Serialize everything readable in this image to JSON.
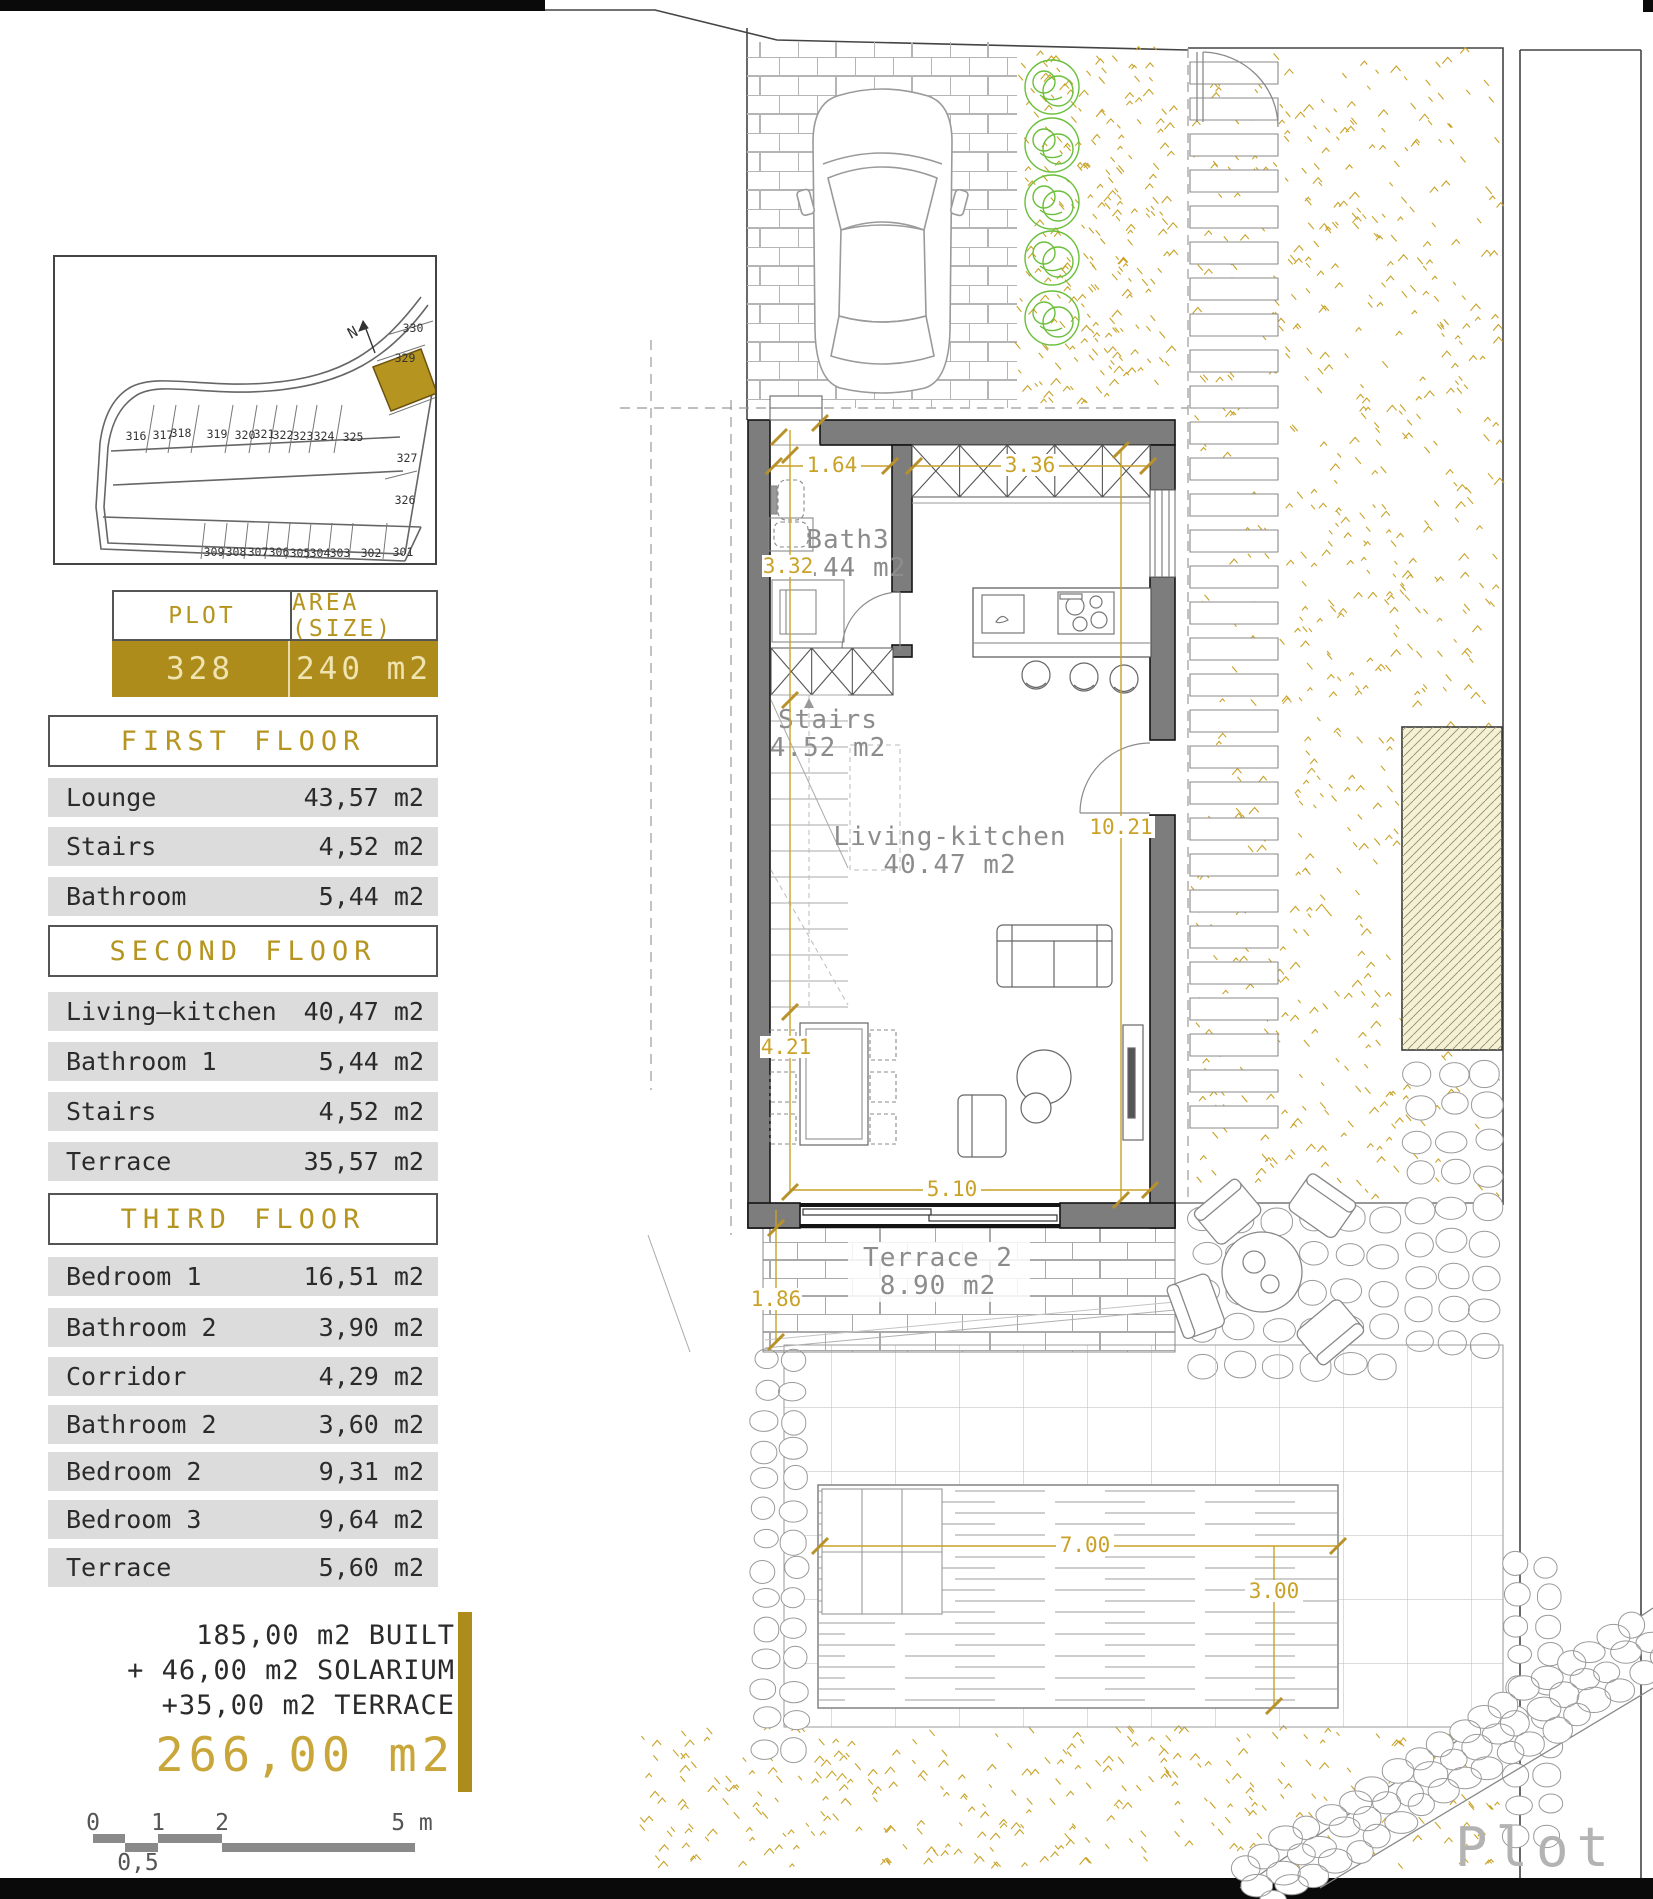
{
  "siteplan": {
    "north_label": "N",
    "highlighted_plot": "328",
    "top_row_plots": [
      "316",
      "317",
      "318",
      "319",
      "320",
      "321",
      "322",
      "323",
      "324",
      "325"
    ],
    "right_plots": [
      "330",
      "329",
      "327",
      "326"
    ],
    "bottom_row_plots": [
      "309",
      "308",
      "307",
      "306",
      "305",
      "304",
      "303",
      "302",
      "301"
    ]
  },
  "plot_table": {
    "plot_header": "PLOT",
    "area_header": "AREA (SIZE)",
    "plot_value": "328",
    "area_value": "240 m2"
  },
  "floors": [
    {
      "title": "FIRST FLOOR",
      "rows": [
        {
          "name": "Lounge",
          "area": "43,57 m2"
        },
        {
          "name": "Stairs",
          "area": "4,52 m2"
        },
        {
          "name": "Bathroom",
          "area": "5,44 m2"
        }
      ]
    },
    {
      "title": "SECOND FLOOR",
      "rows": [
        {
          "name": "Living–kitchen",
          "area": "40,47 m2"
        },
        {
          "name": "Bathroom 1",
          "area": "5,44 m2"
        },
        {
          "name": "Stairs",
          "area": "4,52 m2"
        },
        {
          "name": "Terrace",
          "area": "35,57 m2"
        }
      ]
    },
    {
      "title": "THIRD FLOOR",
      "rows": [
        {
          "name": "Bedroom 1",
          "area": "16,51 m2"
        },
        {
          "name": "Bathroom 2",
          "area": "3,90 m2"
        },
        {
          "name": "Corridor",
          "area": "4,29 m2"
        },
        {
          "name": "Bathroom 2",
          "area": "3,60 m2"
        },
        {
          "name": "Bedroom 2",
          "area": "9,31 m2"
        },
        {
          "name": "Bedroom 3",
          "area": "9,64 m2"
        },
        {
          "name": "Terrace",
          "area": "5,60 m2"
        }
      ]
    }
  ],
  "totals": {
    "lines": [
      "185,00 m2 BUILT",
      "+ 46,00 m2 SOLARIUM",
      "+35,00 m2 TERRACE"
    ],
    "total": "266,00 m2"
  },
  "scalebar": {
    "ticks": [
      "0",
      "1",
      "2"
    ],
    "end_label": "5 m",
    "half_label": "0,5"
  },
  "plan": {
    "rooms": [
      {
        "name": "Bath3",
        "area": "5.44 m2"
      },
      {
        "name": "Stairs",
        "area": "4.52 m2"
      },
      {
        "name": "Living-kitchen",
        "area": "40.47 m2"
      },
      {
        "name": "Terrace 2",
        "area": "8.90 m2"
      }
    ],
    "dimensions": {
      "entrance_width": "1.64",
      "kitchen_width": "3.36",
      "bath_depth": "3.32",
      "interior_length": "10.21",
      "dining_width": "4.21",
      "interior_width": "5.10",
      "terrace_depth": "1.86",
      "pool_length": "7.00",
      "pool_width": "3.00"
    },
    "plot_label": "Plot"
  },
  "colors": {
    "gold": "#ad8c1c",
    "dim_gold": "#c9a227",
    "row_gray": "#dcdcdc",
    "wall_gray": "#7d7d7d",
    "bush_green": "#6abf3a",
    "label_gray": "#8c8c8c"
  }
}
